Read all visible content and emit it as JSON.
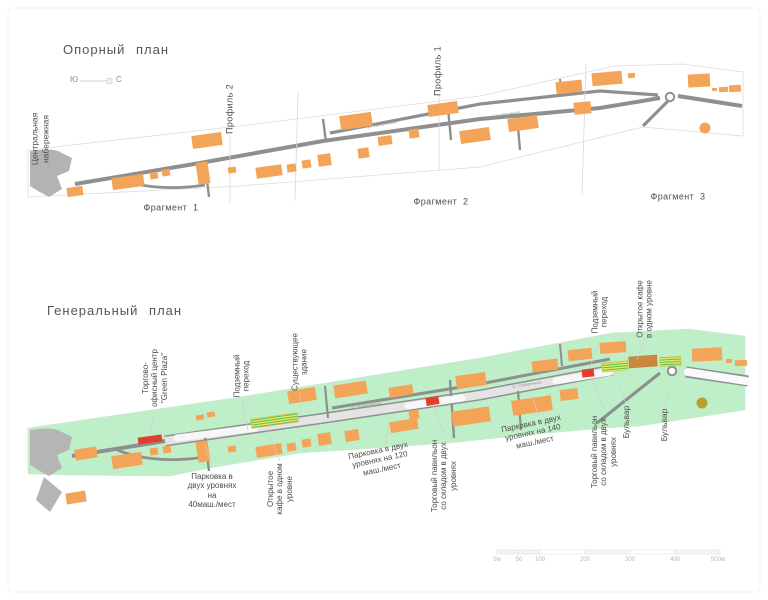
{
  "colors": {
    "building_orange": "#F4A458",
    "band_green": "#BFEFC8",
    "road_gray": "#8F8F8F",
    "road_fill": "#E4E4E4",
    "accent_red": "#E2402F",
    "embankment_gray": "#B3B3B3",
    "stripe_fill": "#DFE96A",
    "stripe_line": "#58B84C",
    "brown_building": "#C9883D",
    "olive_circle": "#B5A22E",
    "text": "#4D4D4D",
    "faint_line": "#CFCFCF"
  },
  "reference_plan": {
    "title": "Опорный план",
    "compass": {
      "south": "Ю",
      "north": "С"
    },
    "embankment_label": "Центральная\nнабережная",
    "street_label": "ул. Набережная",
    "profile_labels": [
      "Профиль 2",
      "Профиль 1"
    ],
    "fragment_labels": [
      "Фрагмент 1",
      "Фрагмент 2",
      "Фрагмент 3"
    ]
  },
  "master_plan": {
    "title": "Генеральный план",
    "street_label": "ул. Набережная",
    "callouts": [
      {
        "id": "green-plaza-center",
        "text": "Торгово-\nофисный центр\n\"Green Plaza\""
      },
      {
        "id": "underground-crossing-left",
        "text": "Подземный\nпереход"
      },
      {
        "id": "existing-building",
        "text": "Существующее\nздание"
      },
      {
        "id": "underground-crossing-right",
        "text": "Подземный\nпереход"
      },
      {
        "id": "open-cafe-right",
        "text": "Открытое кафе\nв одном уровне"
      },
      {
        "id": "parking-40",
        "text": "Парковка в\nдвух уровнях\nна\n40маш./мест"
      },
      {
        "id": "open-cafe-left",
        "text": "Открытое\nкафе в одном\nуровне"
      },
      {
        "id": "parking-120",
        "text": "Парковка в двух\nуровнях на 120\nмаш./мест"
      },
      {
        "id": "trade-pavilion-left",
        "text": "Торговый павильон\nсо складом в двух\nуровнях"
      },
      {
        "id": "parking-140",
        "text": "Парковка в двух\nуровнях на 140\nмаш./мест"
      },
      {
        "id": "trade-pavilion-right",
        "text": "Торговый павильон\nсо складом в двух\nуровнях"
      },
      {
        "id": "boulevard-1",
        "text": "Бульвар"
      },
      {
        "id": "boulevard-2",
        "text": "Бульвар"
      }
    ]
  },
  "scale_bar": {
    "labels": [
      "0м",
      "50",
      "100",
      "200",
      "300",
      "400",
      "500м"
    ]
  }
}
